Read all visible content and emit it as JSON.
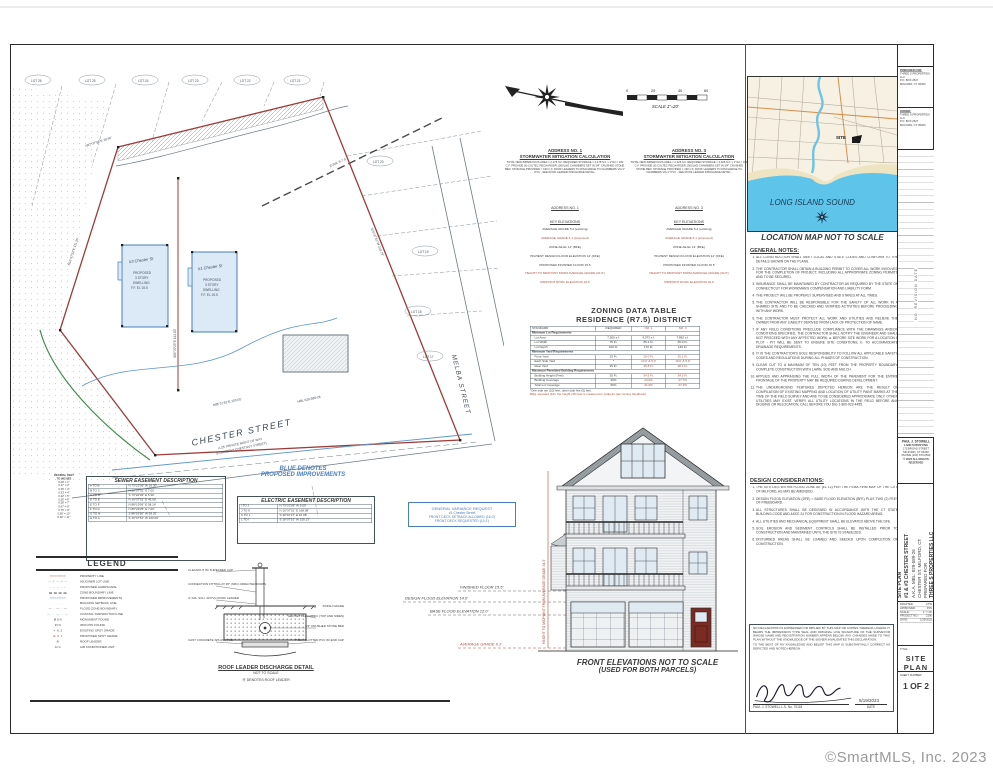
{
  "watermark": "©SmartMLS, Inc.  2023",
  "plan": {
    "lots_top": [
      "LOT 26",
      "LOT 25",
      "LOT 24",
      "LOT 23",
      "LOT 22",
      "LOT 21"
    ],
    "lots_right": [
      "LOT 20",
      "LOT 19",
      "LOT 18",
      "LOT 17"
    ],
    "bldg1": "#3 Chester St",
    "bldg2": "#1 Chester St",
    "bldg_sub": [
      "PROPOSED",
      "3 STORY",
      "DWELLING",
      "F.F. EL 15.5"
    ],
    "street1": "CHESTER STREET",
    "street1_sub1": "A 25' PRIVATE RIGHT OF WAY",
    "street1_sub2": "(FORMERLY CHESTNUT STREET)",
    "street2": "MELBA STREET",
    "bearing_top": "N87°37'56\"E  28.69'",
    "bearing_left": "N16°37'51\"E  111.26'",
    "bearing_split": "S89°29'25\"E  142.00'",
    "bearing_street": "N86°37'51\"E  100.00'",
    "bearing_right": "S16°37'51\"W  218.19'",
    "zone": "ZONE R-7.5",
    "mbl": "MBL 029-589-26"
  },
  "scalebar": {
    "t0": "0",
    "t1": "20",
    "t2": "40",
    "t3": "60",
    "caption": "SCALE 1\"=20'"
  },
  "stormwater": [
    {
      "addr": "ADDRESS NO. 1",
      "title": "STORMWATER MITIGATION CALCULATION",
      "body": "TOTAL NEW IMPERVIOUS AREA = 2,178 S.F. REQUIRED STORAGE = 2,178 S.F. x 1\"/12 = 182 C.F. PROVIDE (6) CULTEC RECHARGER 100XLHD CHAMBERS SET IN 3/4\" CRUSHED STONE BED. STORAGE PROVIDED = 190 C.F. ROOF LEADERS TO DISCHARGE TO CHAMBERS VIA 4\" PVC - SEE ROOF LEADER DISCHARGE DETAIL."
    },
    {
      "addr": "ADDRESS NO. 3",
      "title": "STORMWATER MITIGATION CALCULATION",
      "body": "TOTAL NEW IMPERVIOUS AREA = 2,026 S.F. REQUIRED STORAGE = 2,026 S.F. x 1\"/12 = 169 C.F. PROVIDE (6) CULTEC RECHARGER 100XLHD CHAMBERS SET IN 3/4\" CRUSHED STONE BED. STORAGE PROVIDED = 190 C.F. ROOF LEADERS TO DISCHARGE TO CHAMBERS VIA 4\" PVC - SEE ROOF LEADER DISCHARGE DETAIL."
    }
  ],
  "keyelev": {
    "header1": "ADDRESS NO. 1",
    "header2": "ADDRESS NO. 3",
    "sub": "KEY ELEVATIONS",
    "lines": [
      {
        "t": "AVERAGE GRADE 5.4 (existing)",
        "c": "#3a3a3a"
      },
      {
        "t": "AVERAGE GRADE 6.1 (proposed)",
        "c": "#b04a3c"
      },
      {
        "t": "ZONE AE EL 12' (BFE)",
        "c": "#3a3a3a"
      },
      {
        "t": "HIGHEST DESIGN FLOOD ELEVATION 14' (DFE)",
        "c": "#3a3a3a"
      },
      {
        "t": "PROPOSED FINISHED FLOOR 15.5",
        "c": "#3a3a3a"
      },
      {
        "t": "HEIGHT TO MIDPOINT FROM AVERAGE GRADE (34.5')",
        "c": "#b04a3c"
      },
      {
        "t": "MIDPOINT ROOF ELEVATION 40.6",
        "c": "#b04a3c"
      }
    ]
  },
  "zoning": {
    "title1": "ZONING DATA TABLE",
    "title2": "RESIDENCE (R7.5) DISTRICT",
    "h0": "STANDARD",
    "h1": "REQUIRED",
    "h2": "NO. 1",
    "h3": "NO. 3",
    "s1": {
      "title": "Minimum Lot Requirements",
      "rows": [
        {
          "label": "Lot Area",
          "req": "7,500 s.f.",
          "n1": "9,073 s.f.",
          "n3": "7,892 s.f.",
          "vc": "#3a3a3a"
        },
        {
          "label": "Lot Width",
          "req": "75 Ft.",
          "n1": "86.2 Ft.",
          "n3": "65.0 Ft.",
          "vc": "#3a3a3a"
        },
        {
          "label": "Lot Depth",
          "req": "100 Ft.",
          "n1": "170 Ft.",
          "n3": "140 Ft.",
          "vc": "#3a3a3a"
        }
      ]
    },
    "s2": {
      "title": "Minimum Yard Requirements",
      "rows": [
        {
          "label": "Front Yard",
          "req": "25 Ft.",
          "n1": "25.0 Ft.",
          "n3": "25.1 Ft.",
          "vc": "#b04a3c"
        },
        {
          "label": "Each Side Yard",
          "req": "*",
          "n1": "10.0' & 5.0'",
          "n3": "10.0' & 5.0'",
          "vc": "#b04a3c"
        },
        {
          "label": "Rear Yard",
          "req": "25 Ft.",
          "n1": "25.8 Ft.",
          "n3": "38.4 Ft.",
          "vc": "#b04a3c"
        }
      ]
    },
    "s3": {
      "title": "Maximum Permitted Building Requirements",
      "rows": [
        {
          "label": "Building Height (Feet)",
          "req": "35 Ft.",
          "n1": "34.5 Ft.",
          "n3": "34.5 Ft.",
          "vc": "#b04a3c"
        },
        {
          "label": "Building Coverage",
          "req": "30%",
          "n1": "24.0%",
          "n3": "27.7%",
          "vc": "#b04a3c"
        },
        {
          "label": "Total Lot Coverage",
          "req": "60%",
          "n1": "41.6%",
          "n3": "47.2%",
          "vc": "#b04a3c"
        }
      ]
    },
    "note1": "*One side ten (10) feet, other side five (5) feet.",
    "note2": "Bldg. elevated (FZ): the height (35) feet is measured to midpoint (per zoning handbook)."
  },
  "elevation": {
    "ann": [
      {
        "t": "FINISHED FLOOR  15.5'",
        "c": "#3a3a3a"
      },
      {
        "t": "DESIGN FLOOD ELEVATION  14.0'",
        "c": "#3a3a3a"
      },
      {
        "t": "BASE FLOOD ELEVATION  12.0'",
        "c": "#3a3a3a"
      },
      {
        "t": "AVERAGE GRADE  6.1'",
        "c": "#b04a3c"
      }
    ],
    "height_note": "HEIGHT TO MIDPOINT FROM AVERAGE GRADE 34.5'",
    "caption1": "FRONT ELEVATIONS NOT TO SCALE",
    "caption2": "(USED FOR BOTH PARCELS)"
  },
  "map": {
    "water": "LONG ISLAND SOUND",
    "site": "SITE",
    "caption": "LOCATION MAP NOT TO SCALE"
  },
  "notes": {
    "title": "GENERAL NOTES:",
    "items": [
      "ALL CONSTRUCTION SHALL MEET LOCAL AND STATE CODES AND CONFORM TO THE DETAILS SHOWN ON THE PLANS.",
      "THE CONTRACTOR SHALL OBTAIN A BUILDING PERMIT TO COVER ALL WORK INVOLVED FOR THE COMPLETION OF PROJECT, INCLUDING ALL APPROPRIATE ZONING PERMITS AND TO BE SECURED.",
      "INSURANCE SHALL BE MAINTAINED BY CONTRACTOR AS REQUIRED BY THE STATE OF CONNECTICUT FOR WORKMAN'S COMPENSATION AND LIABILITY FORM.",
      "THE PROJECT WILL BE PROPERLY SUPERVISED AND STAKED AT ALL TIMES.",
      "THE CONTRACTOR WILL BE RESPONSIBLE FOR THE SAFETY OF ALL WORK IN A SHARED SITE AND TO BE CHECKED AND VERIFIED ACTIVITIES BEFORE PROCEEDING WITH ANY WORK.",
      "THE CONTRACTOR MUST PROTECT ALL WORK AND UTILITIES AND RELIEVE THE OWNER FROM ANY LIABILITY DERIVED FROM LACK OF PROTECTION OF SAME.",
      "IF ANY FIELD CONDITIONS PRECLUDE COMPLIANCE WITH THE DRAWINGS AND/OR CONDITIONS SPECIFIED, THE CONTRACTOR SHALL NOTIFY THE ENGINEER AND SHALL NOT PROCEED WITH ANY AFFECTED WORK: a. BEFORE SITE WORK FOR A LOCATION A PLOT - PIT WILL BE SENT TO ENSURE SITE CONDITIONS; b. TO ACCOMMODATE DRAINAGE REQUIREMENTS.",
      "IT IS THE CONTRACTOR'S SOLE RESPONSIBILITY TO FOLLOW ALL APPLICABLE SAFETY CODES AND REGULATIONS DURING ALL PHASES OF CONSTRUCTION.",
      "CLEAR CUT TO A MAXIMUM OF TEN (10) FEET FROM THE PROPERTY BOUNDARY. COMPLETE CONSTRUCTION WITH LAWN, SOD AND MULCH.",
      "APPLIED AND APPRAISING THE FULL WIDTH OF THE PAVEMENT FOR THE ENTIRE FRONTAGE OF THE PROPERTY MAY BE REQUIRED DURING DEVELOPMENT.",
      "THE UNDERGROUND FEATURES DEPICTED HEREON ARE THE RESULT OF COMPILATION OF EXISTING MAPPING AND LOCATION OF UTILITY PAINT MARKS AT THE TIME OF THE FIELD SURVEY AND ARE TO BE CONSIDERED APPROXIMATE ONLY. OTHER UTILITIES MAY EXIST. VERIFY ALL UTILITY LOCATIONS IN THE FIELD BEFORE ANY DIGGING OR RELOCATION. CALL BEFORE YOU DIG 1-800-922-4455."
    ],
    "title2": "DESIGN CONSIDERATIONS:",
    "items2": [
      "THE SITE LIES WITHIN FLOOD ZONE AE (EL 12) PER THE FEMA FIRM MAP OF THE CITY OF MILFORD, AS MAY BE AMENDED.",
      "DESIGN FLOOD ELEVATION (DFE) = BASE FLOOD ELEVATION (BFE) PLUS TWO (2) FEET OF FREEBOARD.",
      "ALL STRUCTURES SHALL BE DESIGNED IN ACCORDANCE WITH THE CT STATE BUILDING CODE AND ASCE 24 FOR CONSTRUCTION IN FLOOD HAZARD AREAS.",
      "ALL UTILITIES AND MECHANICAL EQUIPMENT SHALL BE ELEVATED ABOVE THE DFE.",
      "SOIL EROSION AND SEDIMENT CONTROLS SHALL BE INSTALLED PRIOR TO CONSTRUCTION AND MAINTAINED UNTIL THE SITE IS STABILIZED.",
      "DISTURBED AREAS SHALL BE LOAMED AND SEEDED UPON COMPLETION OF CONSTRUCTION."
    ]
  },
  "declaration": {
    "p1": "NO DECLARATION IS EXPRESSED OR IMPLIED BY THIS MAP OR COPIES THEREOF UNLESS IT BEARS THE IMPRESSION TYPE SEAL AND ORIGINAL LIVE SIGNATURE OF THE SURVEYOR WHOSE NAME AND REGISTRATION NUMBER APPEAR BELOW. ANY CHANGES MADE TO THIS PLAN WITHOUT THE KNOWLEDGE OF THE SIGNER INVALIDATES THIS DECLARATION.",
    "p2": "TO THE BEST OF MY KNOWLEDGE AND BELIEF THIS MAP IS SUBSTANTIALLY CORRECT AS DEPICTED AND NOTED HEREON.",
    "signer": "PAUL J. STOWELL   L.S. No. 70118",
    "date_label": "DATE",
    "date": "5/19/2023"
  },
  "titleblock": {
    "prep_label": "PREPARED FOR:",
    "prep1": "THREE S PROPERTIES LLC",
    "prep2": "P.O. BOX 2527",
    "prep3": "MILFORD, CT 06460",
    "owner_label": "OWNER:",
    "owner1": "THREE S PROPERTIES LLC",
    "owner2": "P.O. BOX 2527",
    "owner3": "MILFORD, CT 06460",
    "rev_header": "NO.      REVISION      DATE",
    "firm1": "PAUL J. STOWELL",
    "firm2": "LAND SURVEYING",
    "firm3": "175 BROAD STREET",
    "firm4": "MILFORD, CT 06460",
    "firm5": "PHONE (203) 874-2593",
    "firm6": "© 2023 ALL RIGHTS RESERVED",
    "proj1": "SITE PLAN",
    "proj2": "#1 & #3 CHESTER STREET",
    "proj3": "A.K.A. MBL: 029-589-26",
    "proj4": "CHESTER ST. MILFORD, CT",
    "proj5": "PREPARED FOR",
    "proj6": "THREE S PROPERTIES LLC",
    "info": [
      {
        "k": "DRAFTED:",
        "v": "CTW"
      },
      {
        "k": "APPROVED:",
        "v": "PJS"
      },
      {
        "k": "SCALE:",
        "v": "1\" = 20'"
      },
      {
        "k": "PROJECT NO.:",
        "v": "2190"
      },
      {
        "k": "DATE:",
        "v": "1/25/2023"
      }
    ],
    "file_label": "FILE:",
    "file": "CHESTER ST_1-3 SITE PLANS",
    "title_label": "TITLE:",
    "title": "SITE PLAN",
    "sheet_label": "SHEET NUMBER:",
    "sheet": "1 OF 2"
  },
  "sewer": {
    "title": "SEWER EASEMENT DESCRIPTION",
    "rows": [
      {
        "a": "A TO B",
        "b": "N 73°22'09\" W  10.30'"
      },
      {
        "a": "B TO C",
        "b": "N 16°37'51\" E  7.00'"
      },
      {
        "a": "C TO D",
        "b": "S 73°22'09\" E  5.30'"
      },
      {
        "a": "D TO E",
        "b": "N 16°37'51\" E  45.00'"
      },
      {
        "a": "E TO F",
        "b": "N 88°19'56\" E  58.14'"
      },
      {
        "a": "F TO G",
        "b": "N 89°29'25\" E  7.00'"
      },
      {
        "a": "G TO H",
        "b": "S 88°19'56\" W  59.20'"
      },
      {
        "a": "H TO A",
        "b": "S 16°37'51\" W  100.00'"
      }
    ]
  },
  "electric": {
    "title": "ELECTRIC EASEMENT DESCRIPTION",
    "rows": [
      {
        "a": "I TO J",
        "b": "N 73°22'09\" W  5.00'"
      },
      {
        "a": "J TO K",
        "b": "N 16°37'51\" E  168.98'"
      },
      {
        "a": "K TO L",
        "b": "S 30°10'37\" E  16.98'"
      },
      {
        "a": "L TO I",
        "b": "S 16°37'51\" W  150.13'"
      }
    ]
  },
  "decimal": {
    "h1": "DECIMAL FEET",
    "h2": "TO INCHES",
    "items": [
      "0.08' = 1\"",
      "0.17' = 2\"",
      "0.25' = 3\"",
      "0.33' = 4\"",
      "0.42' = 5\"",
      "0.50' = 6\"",
      "0.58' = 7\"",
      "0.67' = 8\"",
      "0.75' = 9\"",
      "0.83' = 10\"",
      "0.92' = 11\""
    ]
  },
  "blue_note1": "BLUE DENOTES",
  "blue_note2": "PROPOSED IMPROVEMENTS",
  "variance": [
    "GENERAL VARIANCE REQUEST",
    "#1 Chester Street",
    "FRONT DECK SETBACK ALLOWED (16.0')",
    "FRONT DECK REQUESTED (10.1')"
  ],
  "legend": {
    "title": "LEGEND",
    "items": [
      {
        "symbol": "━━━━━━━",
        "color": "#9c3b38",
        "label": "PROPERTY LINE"
      },
      {
        "symbol": "— ⁄⁄ — ⁄⁄ —",
        "color": "#6b7b85",
        "label": "ADJOINER LOT LINE"
      },
      {
        "symbol": "– – – – –",
        "color": "#6b7b85",
        "label": "PROPOSED HARDSCAPE"
      },
      {
        "symbol": "▬ ▬ ▬ ▬",
        "color": "#3a3a3a",
        "label": "ZONE BOUNDARY LINE"
      },
      {
        "symbol": "━━━━━━━",
        "color": "#4a7fb5",
        "label": "PROPOSED IMPROVEMENTS"
      },
      {
        "symbol": "· · · · · ·",
        "color": "#6b7b85",
        "label": "BUILDING SETBACK LINE"
      },
      {
        "symbol": "— · — · —",
        "color": "#3a3a3a",
        "label": "FLOOD ZONE BOUNDARY"
      },
      {
        "symbol": "— ·· — ·· —",
        "color": "#4a7fb5",
        "label": "COASTAL JURISDICTION LINE"
      },
      {
        "symbol": "MON",
        "color": "#3a3a3a",
        "label": "MONUMENT FOUND"
      },
      {
        "symbol": "PIN",
        "color": "#3a3a3a",
        "label": "IRON PIN FOUND"
      },
      {
        "symbol": "× 6.2",
        "color": "#3a3a3a",
        "label": "EXISTING SPOT GRADE"
      },
      {
        "symbol": "⊕ 6.1",
        "color": "#b04a3c",
        "label": "PROPOSED SPOT GRADE"
      },
      {
        "symbol": "Ⓡ",
        "color": "#3a3a3a",
        "label": "ROOF LEADER"
      },
      {
        "symbol": "A/C",
        "color": "#3a3a3a",
        "label": "AIR CONDITIONER UNIT"
      }
    ]
  },
  "detail": {
    "title": "ROOF LEADER DISCHARGE DETAIL",
    "sub": "NOT TO SCALE",
    "foot": "Ⓡ  DENOTES ROOF LEADER",
    "cl0": "CLEANOUT W/ THREADED CAP",
    "cl1": "CONNECTION FITTING AT 45° (MIN.) DIRECTED DOWN",
    "cl2": "4\" DIA. SCH. 40 PVC ROOF LEADER",
    "cl3": "CAST CONCRETE SPLASH PAD",
    "cr0": "FINISH GRADE",
    "cr1": "GEOTEXTILE FABRIC (TOP AND SIDES)",
    "cr2": "3/4\" CRUSHED STONE BED",
    "cr3": "4\" DIA. SLOTTED PVC W/ END CAP"
  }
}
